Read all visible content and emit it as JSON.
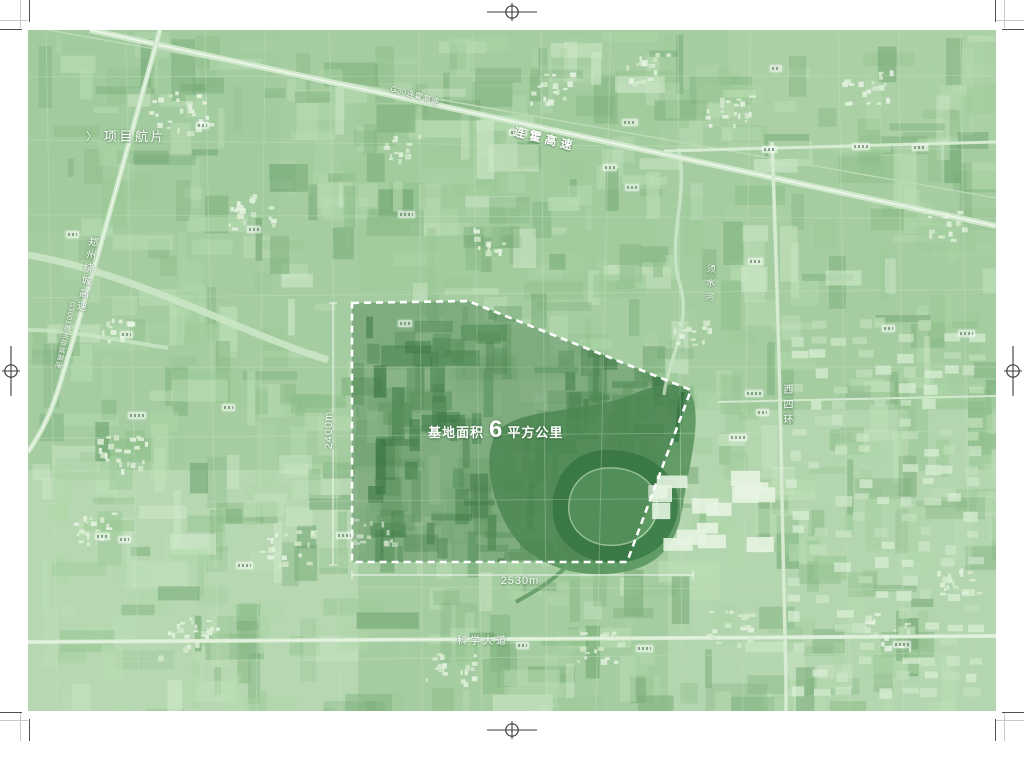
{
  "map": {
    "title": {
      "chevron": "〉",
      "text": "项目航片"
    },
    "area_label": {
      "prefix": "基地面积",
      "value": "6",
      "suffix": "平方公里"
    },
    "dimensions": {
      "height_label": "2400m",
      "width_label": "2530m"
    },
    "labels": {
      "expressway_main": "连霍高速",
      "expressway_main_small": "G30连霍高速",
      "ring_expressway": "郑州绕城高速",
      "ring_expressway_small": "G3001郑州绕城高速",
      "west_fourth_ring": "西四环",
      "science_avenue": "科学大道",
      "xushui_river": "须水河"
    },
    "colors": {
      "map_base": "#a6cda2",
      "site_boundary": "#ffffff",
      "label_text": "#ffffff"
    }
  }
}
